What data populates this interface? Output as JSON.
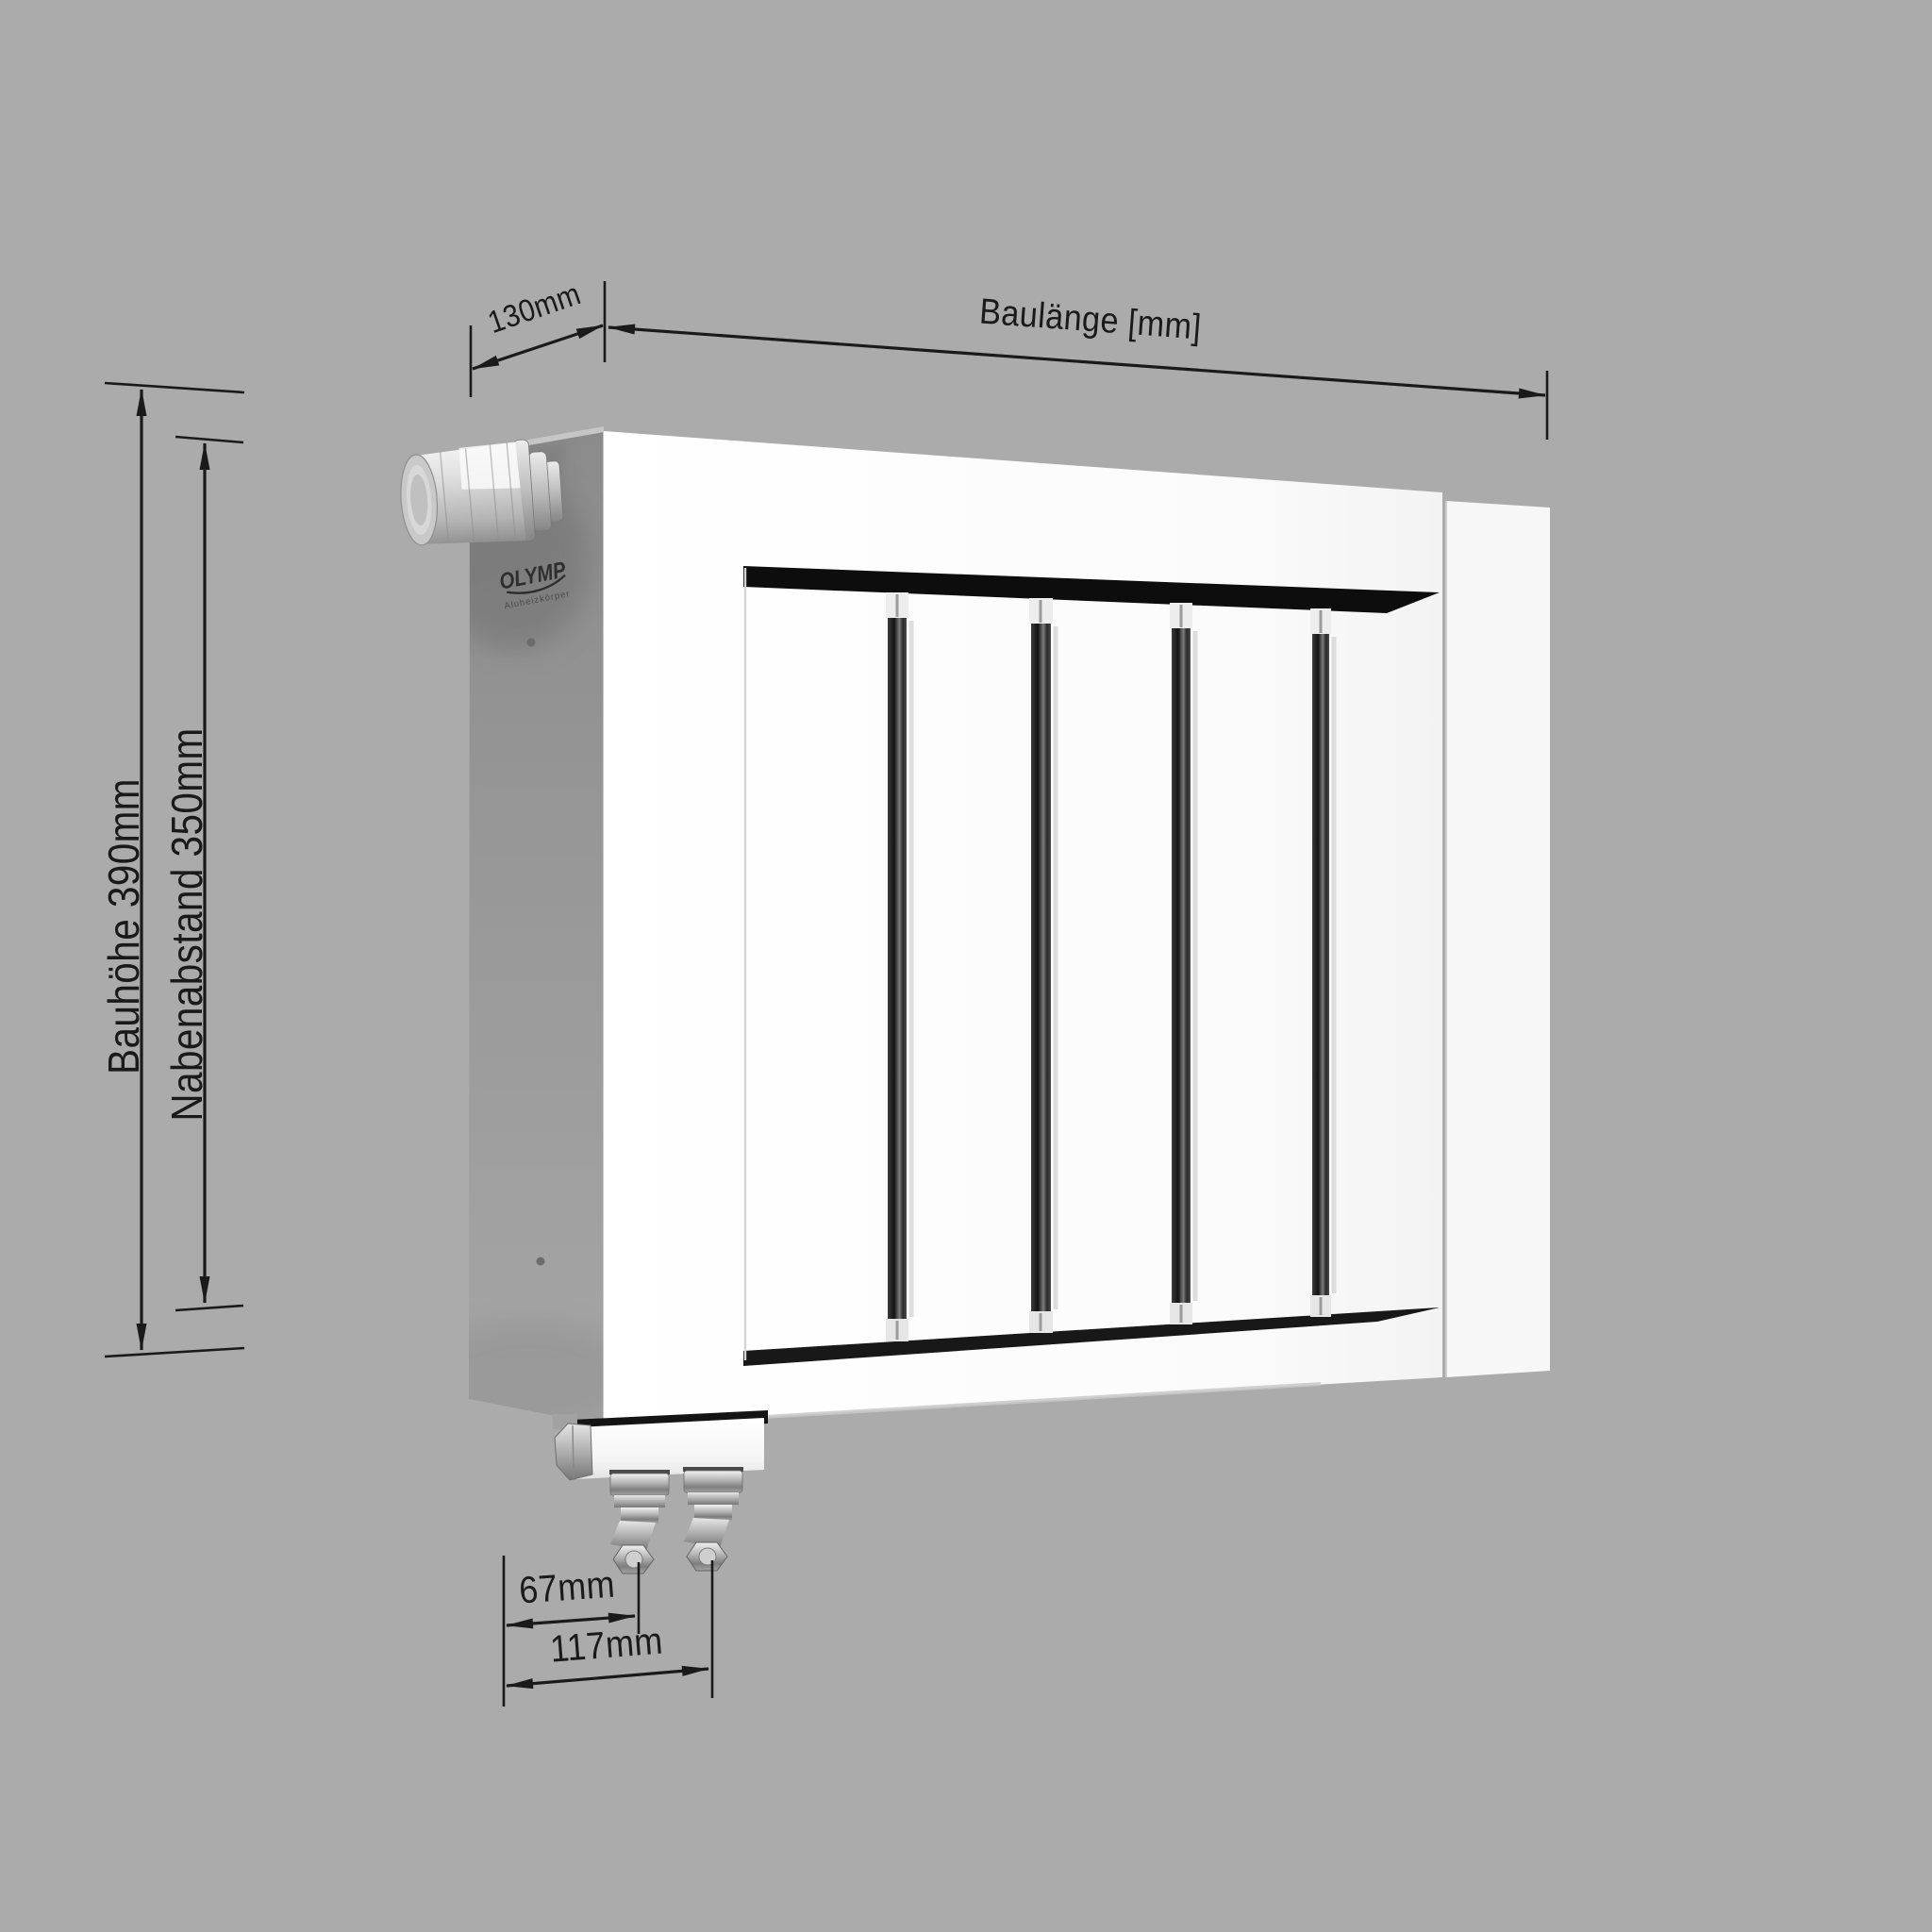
{
  "scene": {
    "background_color": "#ababab",
    "line_color": "#1a1a1a"
  },
  "dimensions": {
    "depth": {
      "label": "130mm"
    },
    "length": {
      "label": "Baulänge [mm]"
    },
    "build_height": {
      "label": "Bauhöhe 390mm"
    },
    "hub_distance": {
      "label": "Nabenabstand 350mm"
    },
    "valve_spacing_near": {
      "label": "67mm"
    },
    "valve_spacing_far": {
      "label": "117mm"
    }
  },
  "radiator": {
    "brand": "OLYMP",
    "brand_tagline": "Aluheizkörper",
    "fin_count": 5,
    "colors": {
      "front": "#ffffff",
      "side": "#979797",
      "slot": "#1e1e1e",
      "valve_chrome": "#c9c9c9"
    }
  }
}
